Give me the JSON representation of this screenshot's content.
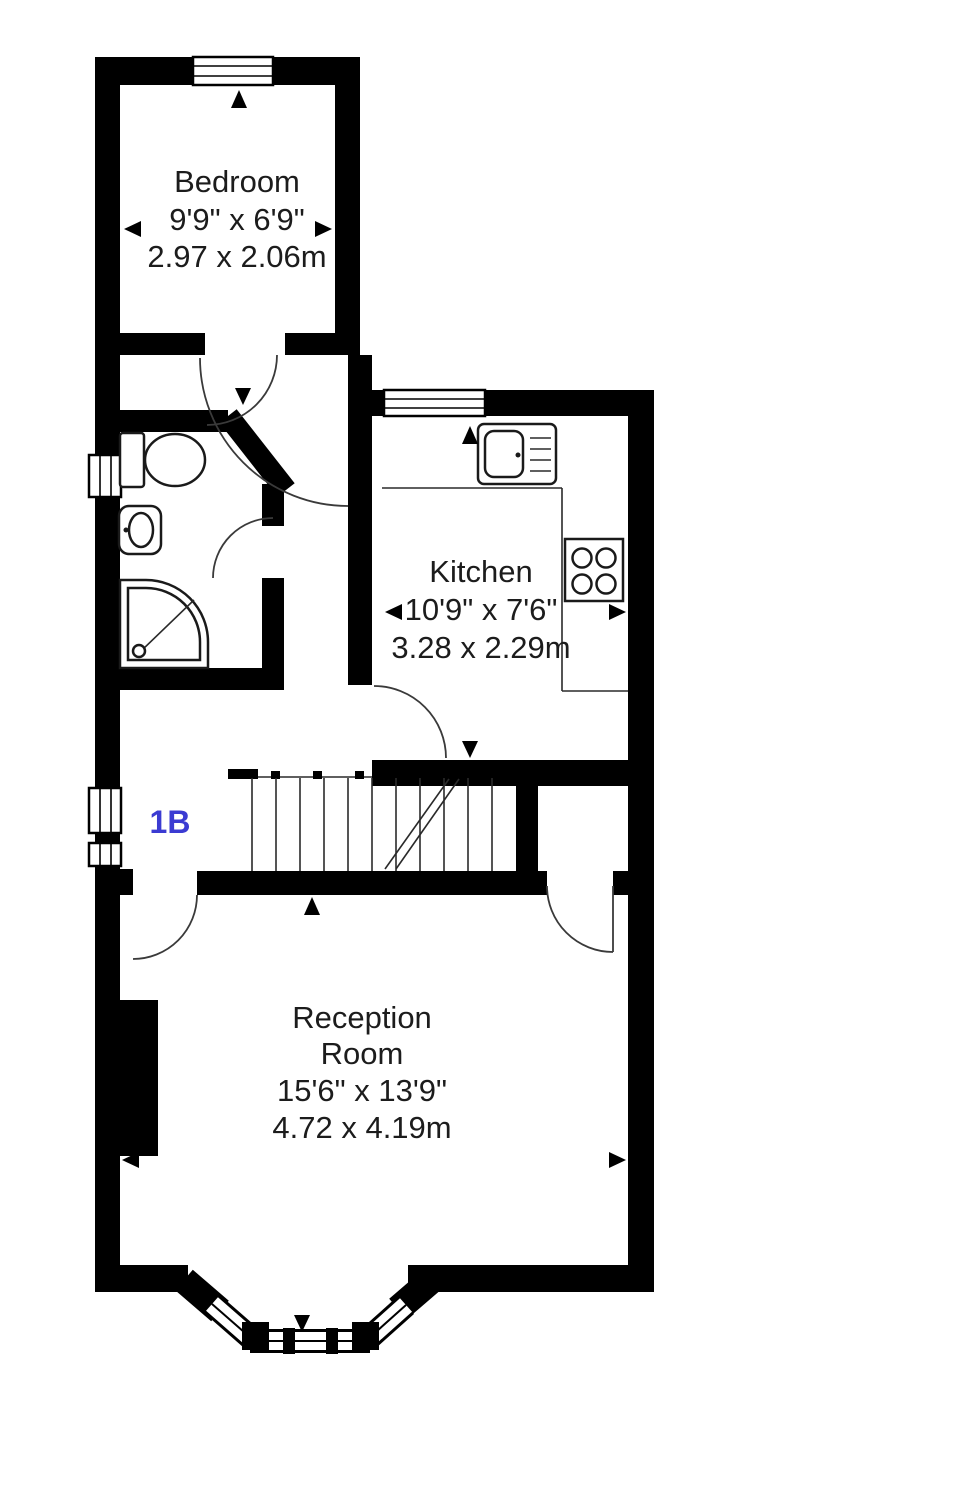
{
  "floorplan": {
    "unit_label": "1B",
    "rooms": {
      "bedroom": {
        "name": "Bedroom",
        "imperial": "9'9\" x 6'9\"",
        "metric": "2.97 x 2.06m"
      },
      "kitchen": {
        "name": "Kitchen",
        "imperial": "10'9\" x 7'6\"",
        "metric": "3.28 x 2.29m"
      },
      "reception": {
        "name_line1": "Reception",
        "name_line2": "Room",
        "imperial": "15'6\" x 13'9\"",
        "metric": "4.72 x 4.19m"
      }
    },
    "fixtures": [
      "toilet-icon",
      "washbasin-icon",
      "shower-icon",
      "kitchen-sink-icon",
      "hob-icon",
      "staircase",
      "bay-window",
      "chimney-breast",
      "window",
      "door-arc",
      "dimension-arrow"
    ],
    "colors": {
      "walls": "#000000",
      "text": "#1c1c1c",
      "unit_label": "#3b3bd2",
      "background": "#ffffff"
    }
  }
}
